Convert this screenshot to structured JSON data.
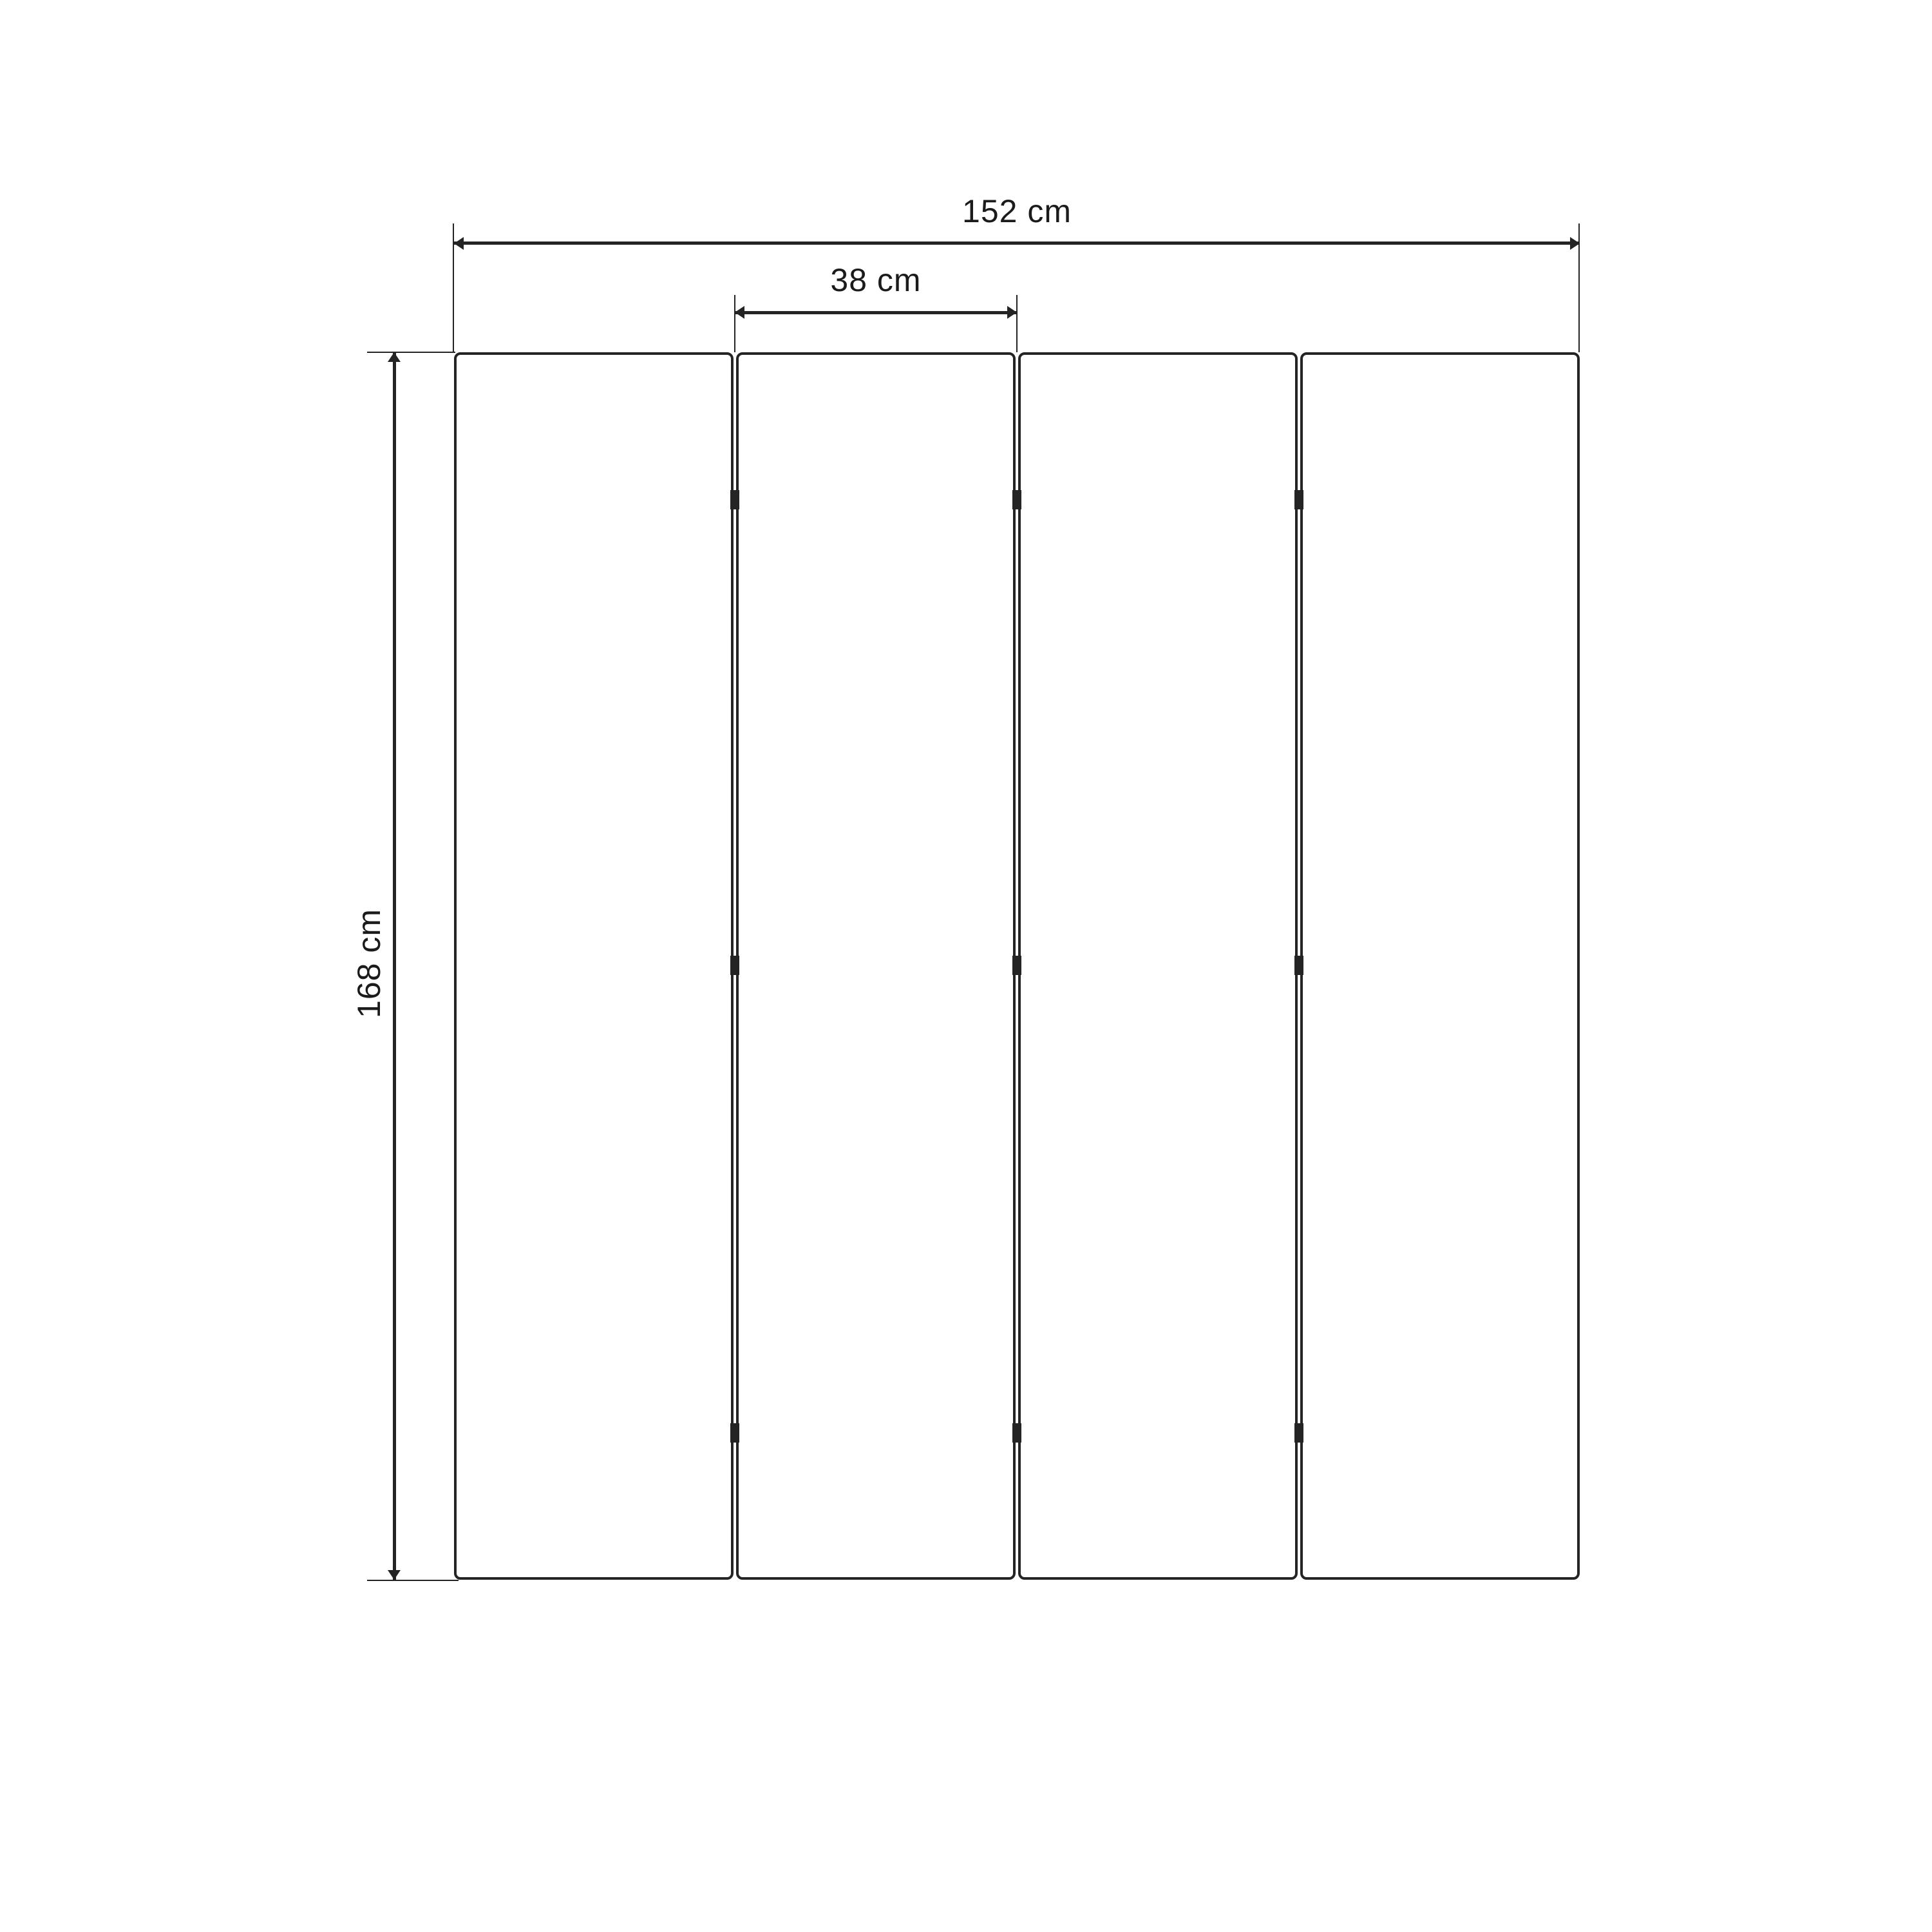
{
  "diagram": {
    "panel_count": 4,
    "hinge_rows": 3,
    "dimensions": {
      "total_width": "152 cm",
      "panel_width": "38 cm",
      "height": "168 cm"
    },
    "colors": {
      "background": "#ffffff",
      "line": "#242424",
      "text": "#1b1b1b"
    }
  }
}
